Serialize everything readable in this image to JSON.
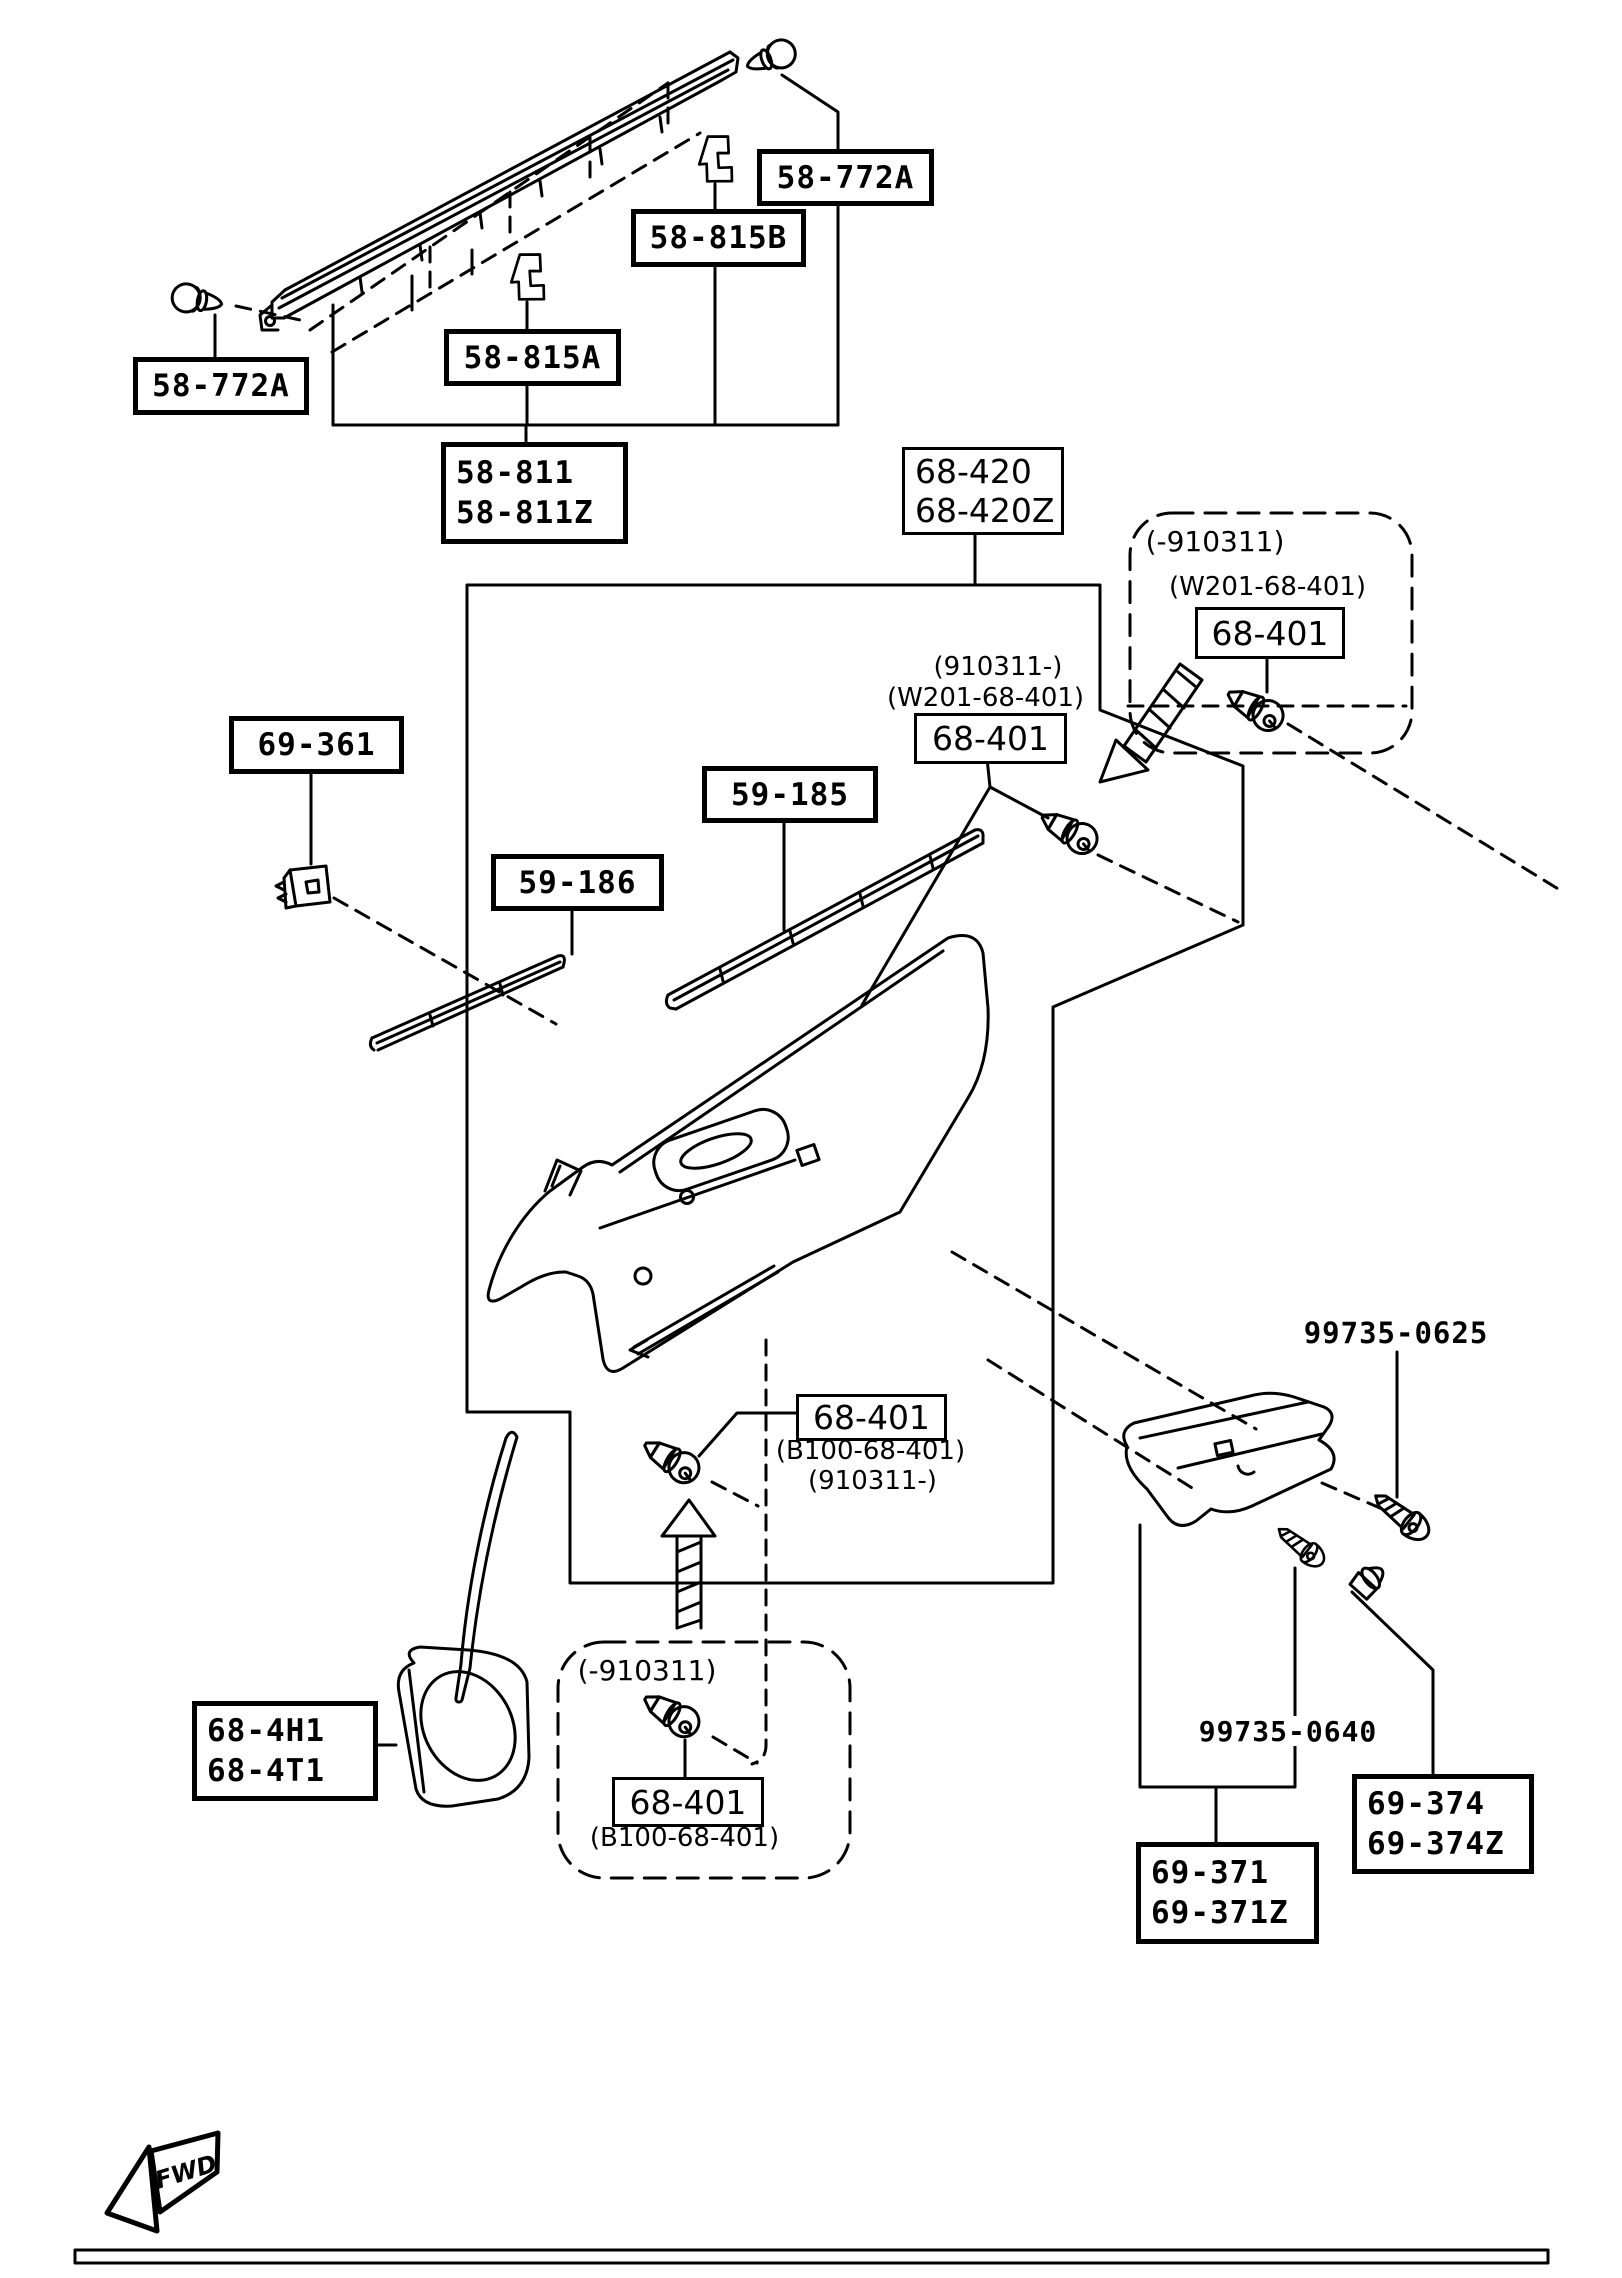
{
  "ink": "#000000",
  "paper": "#ffffff",
  "labels": {
    "plug_left": "58-772A",
    "plug_right": "58-772A",
    "clip_row_upper": "58-815B",
    "clip_row_lower": "58-815A",
    "belt_molding_line1": "58-811",
    "belt_molding_line2": "58-811Z",
    "fastener_69361": "69-361",
    "molding_59185": "59-185",
    "molding_59186": "59-186",
    "trim_panel_line1": "68-420",
    "trim_panel_line2": "68-420Z",
    "range_pre_910311_right": "(-910311)",
    "kit_w201_right": "(W201-68-401)",
    "screw_right": "68-401",
    "range_post_910311_mid": "(910311-)",
    "kit_w201_mid": "(W201-68-401)",
    "screw_mid": "68-401",
    "screw_lower_mid": "68-401",
    "kit_b100_lower_mid": "(B100-68-401)",
    "range_post_910311_lower": "(910311-)",
    "range_pre_910311_bottom": "(-910311)",
    "screw_bottom": "68-401",
    "kit_b100_bottom": "(B100-68-401)",
    "speaker_grille_line1": "68-4H1",
    "speaker_grille_line2": "68-4T1",
    "screw_99735_0625": "99735-0625",
    "screw_99735_0640": "99735-0640",
    "clip_69374_line1": "69-374",
    "clip_69374_line2": "69-374Z",
    "armrest_line1": "69-371",
    "armrest_line2": "69-371Z",
    "fwd_marker": "FWD"
  }
}
